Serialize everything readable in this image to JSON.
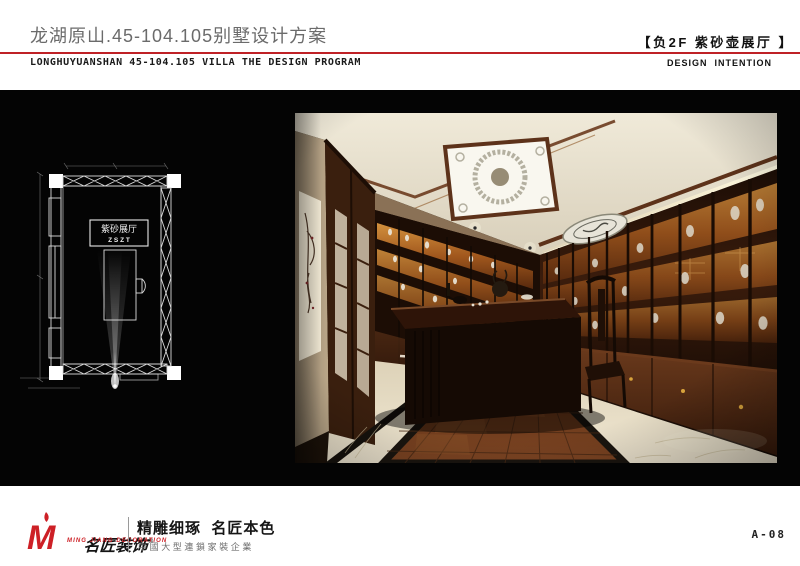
{
  "header": {
    "title_cn": "龙湖原山.45-104.105别墅设计方案",
    "subtitle_en": "LONGHUYUANSHAN 45-104.105 VILLA THE DESIGN PROGRAM",
    "section_title_cn": "【负2F 紫砂壶展厅 】",
    "section_subtitle_en": "DESIGN  INTENTION",
    "rule_color": "#bf2126"
  },
  "floor_plan": {
    "room_label_cn": "紫砂展厅",
    "room_label_code": "Z S Z T",
    "line_color": "#dcdcdc",
    "background": "#040404"
  },
  "rendering": {
    "colors": {
      "ceiling_cream": "#eae3d2",
      "wood_dark": "#3a1d0c",
      "cabinet_glow_amber": "#c87a28",
      "floor_parquet": "#7c4522",
      "floor_marble": "#e9dfc8"
    }
  },
  "footer": {
    "logo_monogram": "M",
    "brand_cn": "名匠装饰",
    "registered_mark": "®",
    "brand_en": "MING JIANG DECORATION",
    "slogan_cn": "精雕细琢  名匠本色",
    "slogan_sub_cn": "中國大型連鎖家裝企業",
    "page_no": "A-08",
    "brand_color": "#cd2026"
  }
}
